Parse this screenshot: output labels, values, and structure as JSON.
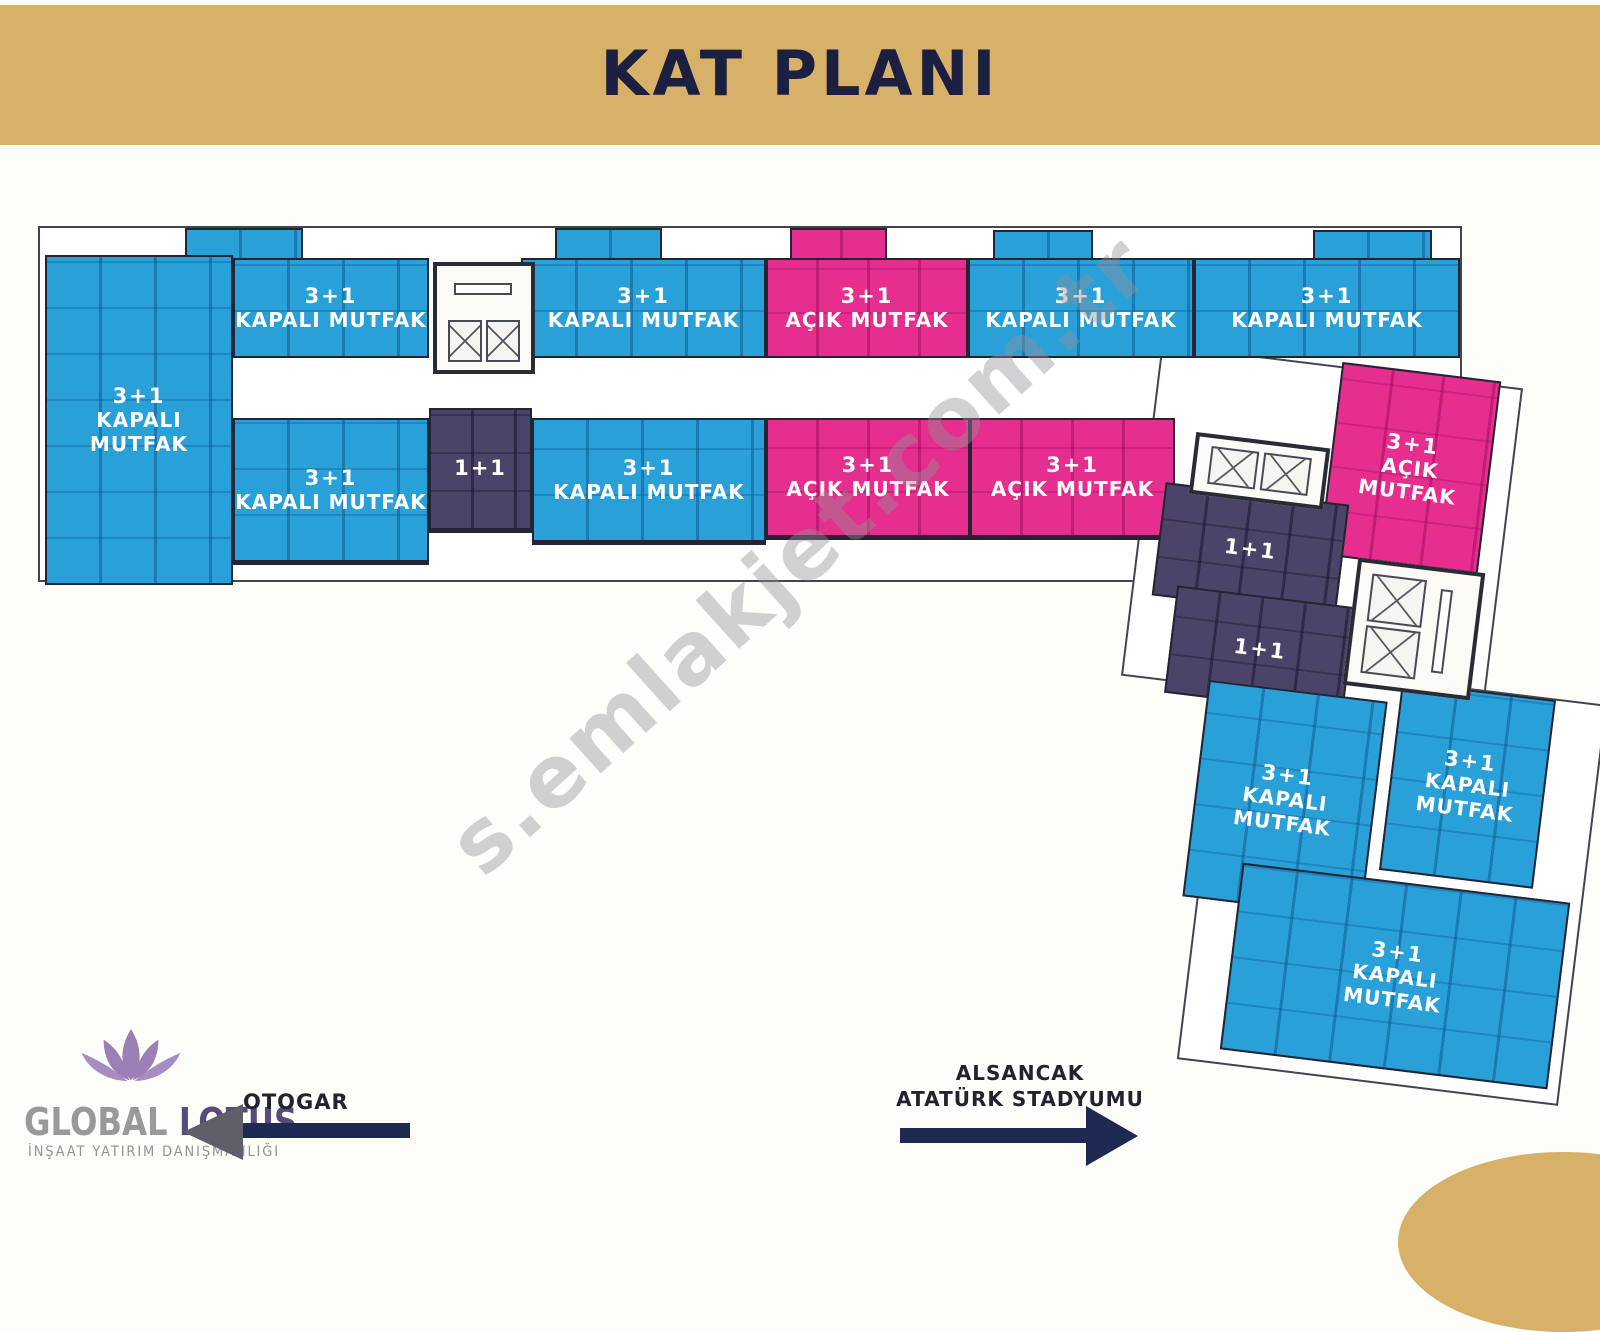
{
  "header": {
    "title": "KAT PLANI"
  },
  "watermark": {
    "text": "s.emlakjet.com.tr"
  },
  "palette": {
    "header_gold": "#d8b169",
    "unit_blue": "#2aa0d8",
    "unit_pink": "#e52e8d",
    "unit_purple": "#4b4468",
    "wall_dark": "#242433",
    "arrow_navy": "#1e2a52",
    "title_navy": "#1b2040"
  },
  "plan": {
    "units": [
      {
        "type": "3+1",
        "kitchen": "KAPALI MUTFAK",
        "color": "blue"
      },
      {
        "type": "3+1",
        "kitchen": "KAPALI MUTFAK",
        "color": "blue"
      },
      {
        "type": "3+1",
        "kitchen": "KAPALI MUTFAK",
        "color": "blue"
      },
      {
        "type": "3+1",
        "kitchen": "AÇIK MUTFAK",
        "color": "pink"
      },
      {
        "type": "3+1",
        "kitchen": "KAPALI MUTFAK",
        "color": "blue"
      },
      {
        "type": "3+1",
        "kitchen": "KAPALI MUTFAK",
        "color": "blue"
      },
      {
        "type": "3+1",
        "kitchen": "KAPALI MUTFAK",
        "color": "blue"
      },
      {
        "type": "1+1",
        "kitchen": "",
        "color": "purple"
      },
      {
        "type": "3+1",
        "kitchen": "KAPALI MUTFAK",
        "color": "blue"
      },
      {
        "type": "3+1",
        "kitchen": "AÇIK MUTFAK",
        "color": "pink"
      },
      {
        "type": "3+1",
        "kitchen": "AÇIK MUTFAK",
        "color": "pink"
      },
      {
        "type": "3+1",
        "kitchen": "AÇIK MUTFAK",
        "color": "pink"
      },
      {
        "type": "1+1",
        "kitchen": "",
        "color": "purple"
      },
      {
        "type": "1+1",
        "kitchen": "",
        "color": "purple"
      },
      {
        "type": "3+1",
        "kitchen": "KAPALI MUTFAK",
        "color": "blue"
      },
      {
        "type": "3+1",
        "kitchen": "KAPALI MUTFAK",
        "color": "blue"
      },
      {
        "type": "3+1",
        "kitchen": "KAPALI MUTFAK",
        "color": "blue"
      }
    ],
    "icons": [
      "elevator-shaft-x-icon",
      "stair-icon"
    ]
  },
  "footer": {
    "logo": {
      "icon": "lotus-flower-icon",
      "brand_primary": "GLOBAL",
      "brand_secondary": "LOTUS",
      "tagline": "İNŞAAT YATIRIM DANIŞMANLIĞI"
    },
    "direction_left": {
      "label": "OTOGAR",
      "arrow": "left"
    },
    "direction_right": {
      "label_line1": "ALSANCAK",
      "label_line2": "ATATÜRK STADYUMU",
      "arrow": "right"
    }
  }
}
